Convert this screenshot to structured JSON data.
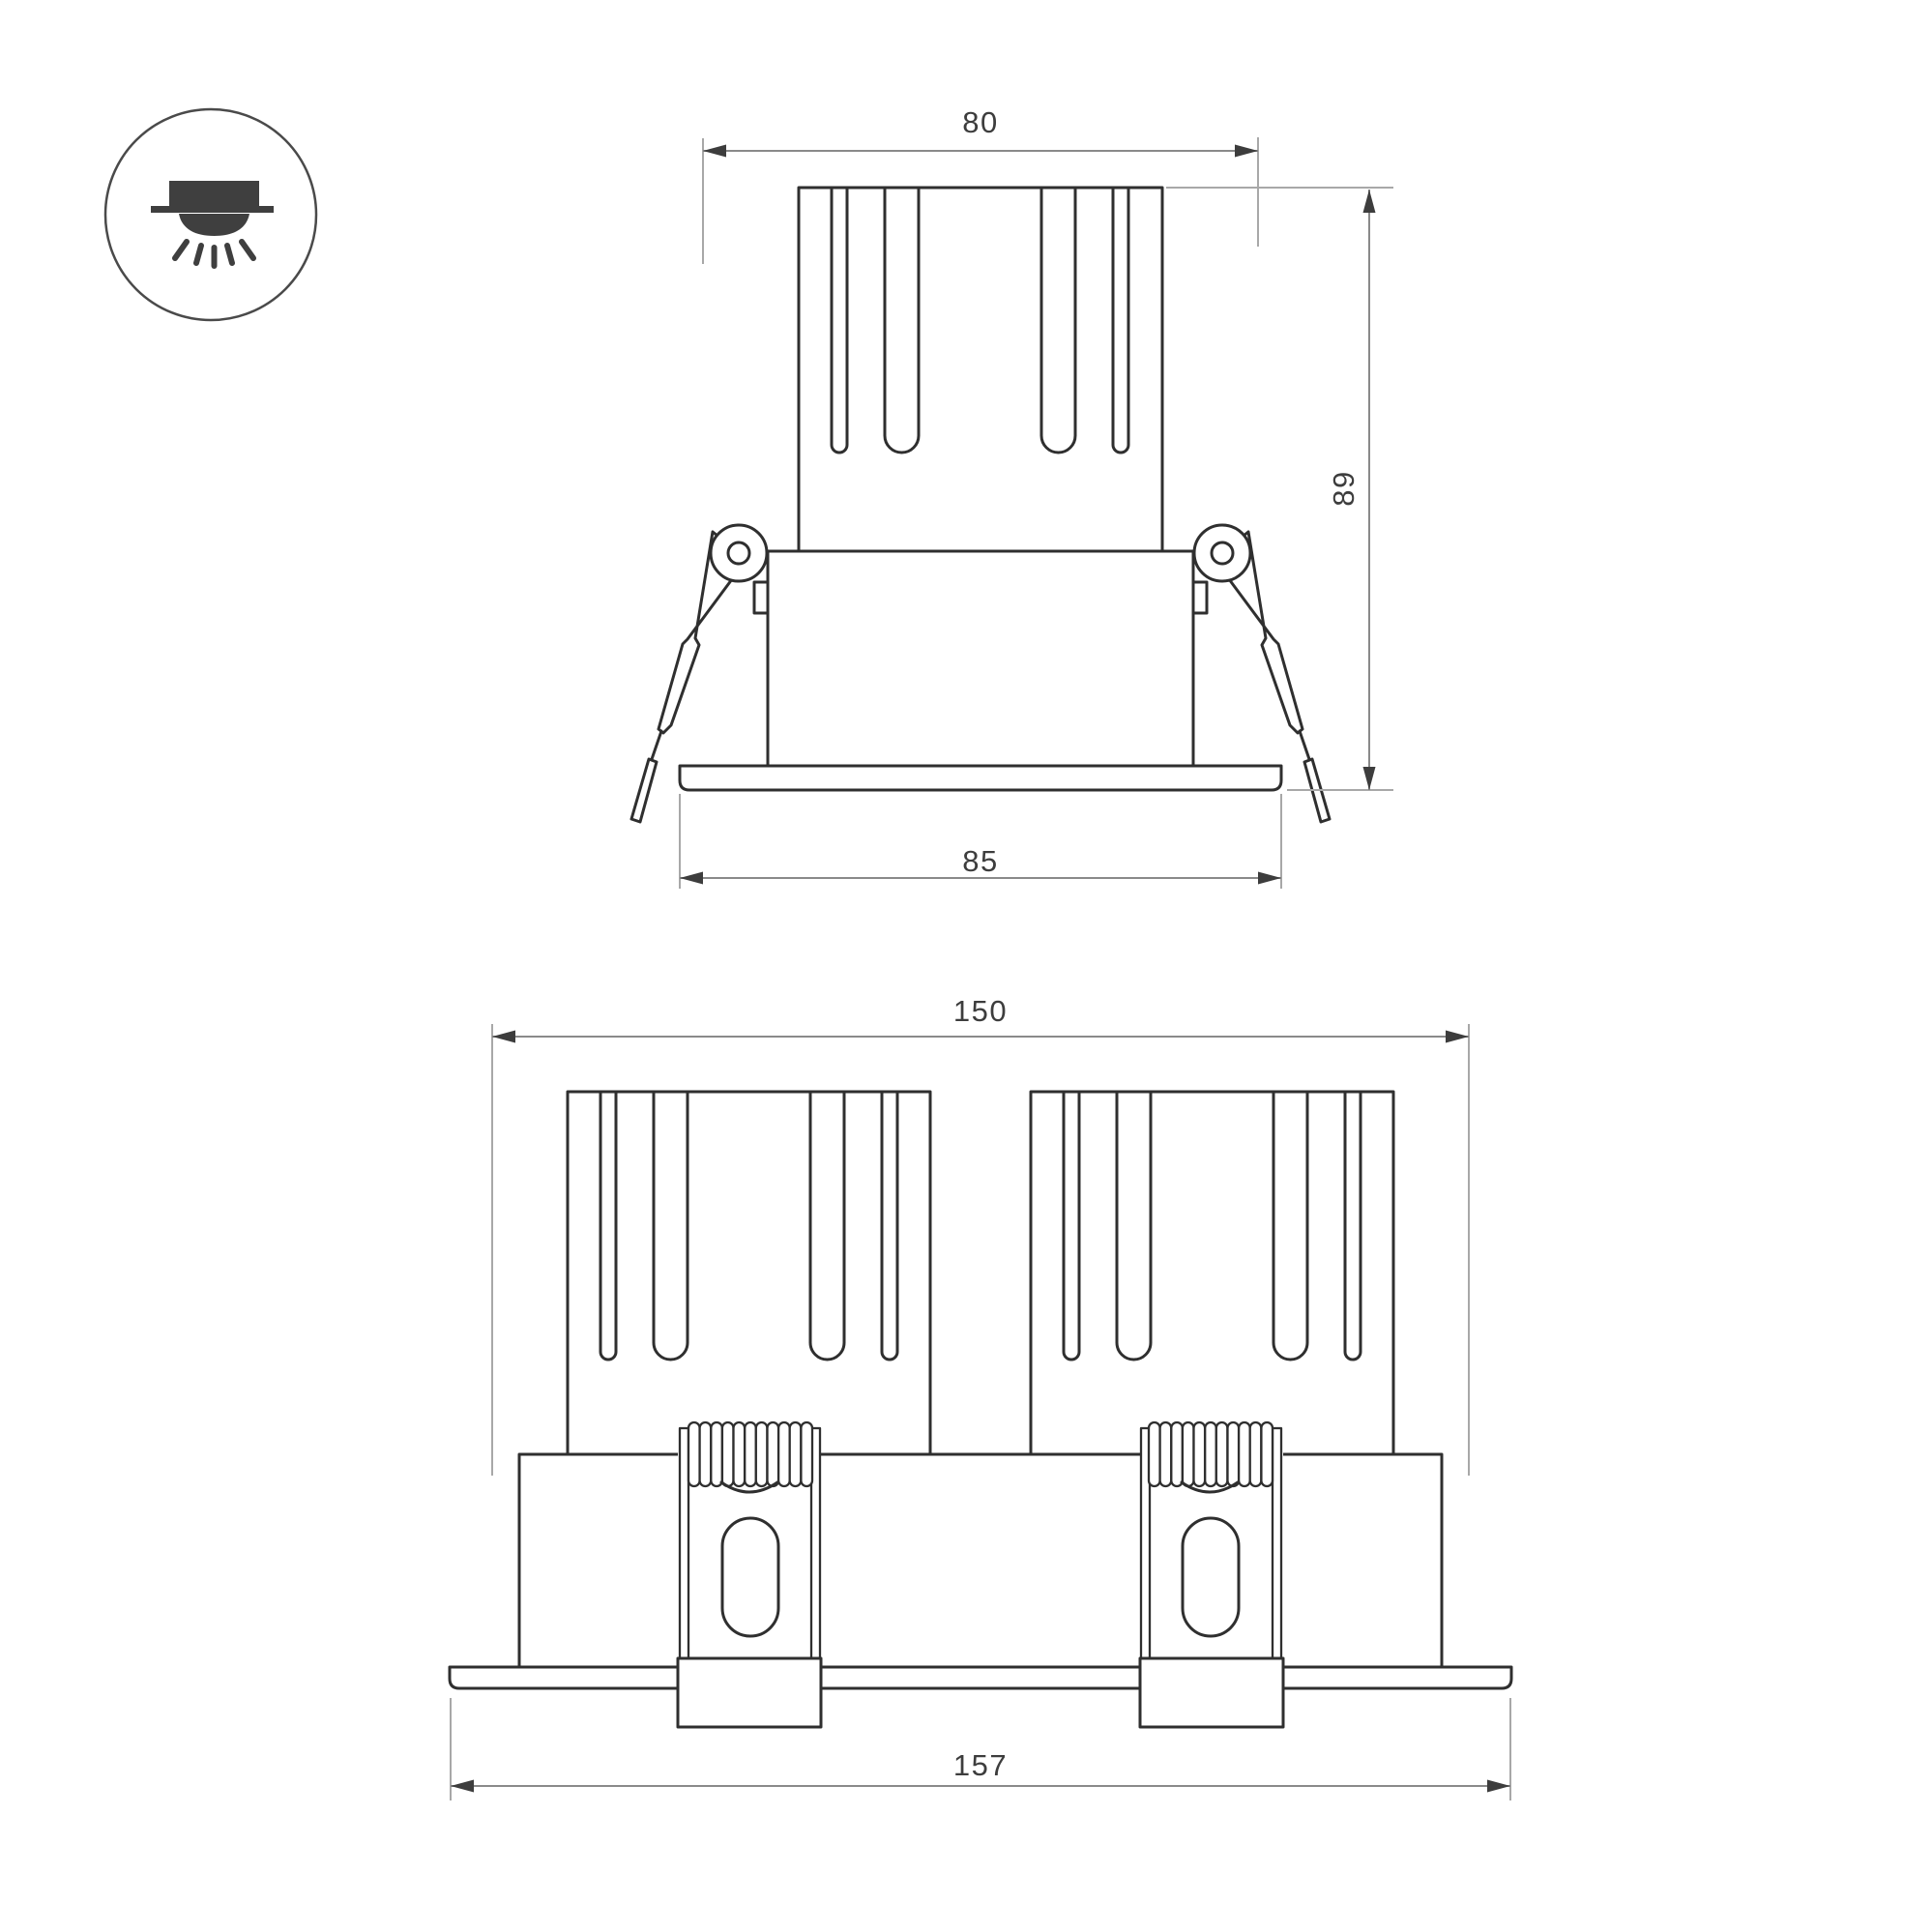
{
  "document": {
    "type": "luminaire dimension drawing",
    "background": "#ffffff"
  },
  "icon": {
    "name": "recessed-downlight-icon"
  },
  "views": {
    "front": {
      "name": "single-module-front-view",
      "dims": {
        "cutout_width": "80",
        "height": "89",
        "flange_width": "85"
      }
    },
    "double": {
      "name": "double-module-front-view",
      "dims": {
        "cutout_width": "150",
        "flange_width": "157"
      }
    }
  },
  "colors": {
    "object-line": "#2f2f2f",
    "dim-line": "#8a8a8a",
    "ext-line": "#a8a8a8",
    "arrow": "#3d3d3d",
    "dim-text": "#3d3d3d",
    "icon": "#3f3f3f",
    "background": "#ffffff"
  }
}
